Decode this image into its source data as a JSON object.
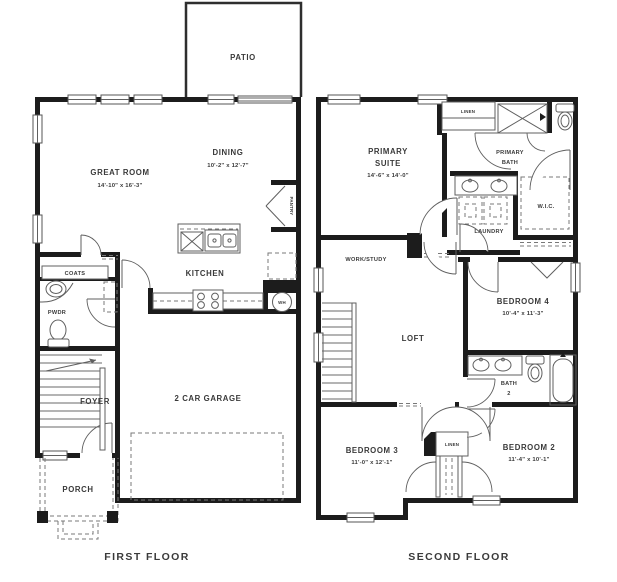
{
  "colors": {
    "wall": "#1c1c1c",
    "thin_line": "#5f5f5f",
    "text": "#3a3a3a",
    "background": "#ffffff"
  },
  "first_floor": {
    "caption": "FIRST FLOOR",
    "rooms": {
      "patio": {
        "label": "PATIO"
      },
      "great_room": {
        "label": "GREAT ROOM",
        "dims": "14'-10\" x 16'-3\""
      },
      "dining": {
        "label": "DINING",
        "dims": "10'-2\" x 12'-7\""
      },
      "kitchen": {
        "label": "KITCHEN"
      },
      "pantry": {
        "label": "PANTRY"
      },
      "coats": {
        "label": "COATS"
      },
      "powder": {
        "label": "PWDR"
      },
      "foyer": {
        "label": "FOYER"
      },
      "porch": {
        "label": "PORCH"
      },
      "garage": {
        "label": "2 CAR GARAGE"
      },
      "water_heater": {
        "label": "WH"
      }
    }
  },
  "second_floor": {
    "caption": "SECOND FLOOR",
    "rooms": {
      "primary_suite": {
        "label_line1": "PRIMARY",
        "label_line2": "SUITE",
        "dims": "14'-6\" x 14'-0\""
      },
      "linen_upper": {
        "label": "LINEN"
      },
      "primary_bath": {
        "label_line1": "PRIMARY",
        "label_line2": "BATH"
      },
      "wic": {
        "label": "W.I.C."
      },
      "laundry": {
        "label": "LAUNDRY"
      },
      "work_study": {
        "label": "WORK/STUDY"
      },
      "loft": {
        "label": "LOFT"
      },
      "bedroom4": {
        "label": "BEDROOM 4",
        "dims": "10'-4\" x 11'-3\""
      },
      "bath2": {
        "label_line1": "BATH",
        "label_line2": "2"
      },
      "bedroom3": {
        "label": "BEDROOM 3",
        "dims": "11'-0\" x 12'-1\""
      },
      "linen_lower": {
        "label": "LINEN"
      },
      "bedroom2": {
        "label": "BEDROOM 2",
        "dims": "11'-4\" x 10'-1\""
      }
    }
  }
}
